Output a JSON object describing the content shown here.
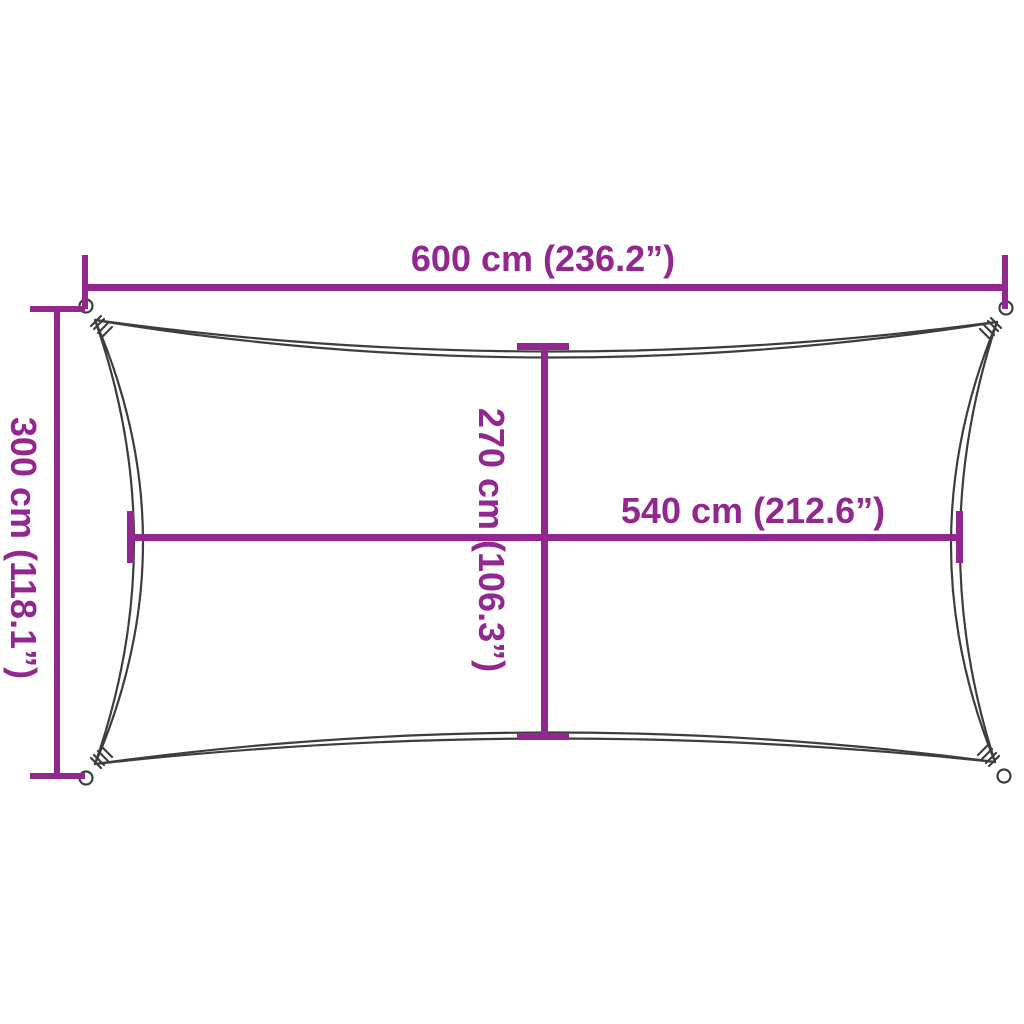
{
  "diagram": {
    "colors": {
      "dimension_line": "#92278F",
      "sail_outline": "#3D3D3D",
      "background": "#FFFFFF"
    },
    "dimensions": {
      "width_total": "600 cm (236.2”)",
      "height_total": "300 cm (118.1”)",
      "height_inner": "270 cm (106.3”)",
      "width_inner": "540 cm (212.6”)"
    }
  }
}
